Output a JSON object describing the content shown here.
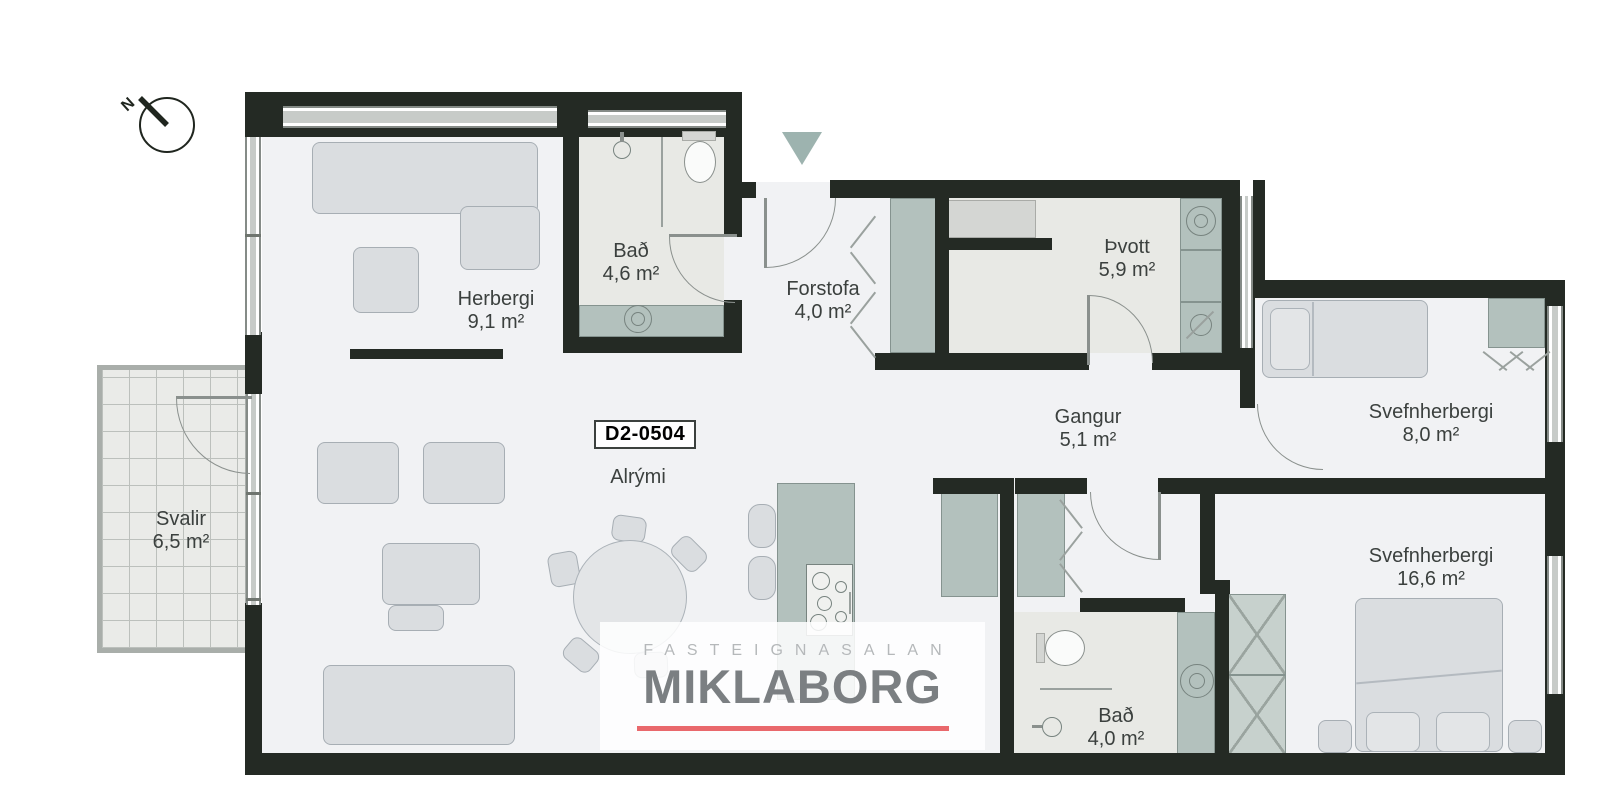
{
  "compass": {
    "label": "N"
  },
  "unit": {
    "code": "D2-0504",
    "open_area_label": "Alrými"
  },
  "rooms": [
    {
      "name": "Herbergi",
      "area": "9,1 m²"
    },
    {
      "name": "Bað",
      "area": "4,6 m²"
    },
    {
      "name": "Forstofa",
      "area": "4,0 m²"
    },
    {
      "name": "Þvott",
      "area": "5,9 m²"
    },
    {
      "name": "Gangur",
      "area": "5,1 m²"
    },
    {
      "name": "Svefnherbergi",
      "area": "8,0 m²"
    },
    {
      "name": "Svefnherbergi",
      "area": "16,6 m²"
    },
    {
      "name": "Bað",
      "area": "4,0 m²"
    },
    {
      "name": "Svalir",
      "area": "6,5 m²"
    }
  ],
  "logo": {
    "tagline": "FASTEIGNASALAN",
    "brand": "MIKLABORG"
  },
  "colors": {
    "wall": "#242a24",
    "floor_light": "#f1f2f4",
    "floor_gray": "#e8e9e5",
    "fixture_teal": "#b3c1bd",
    "furniture_gray": "#dadde0",
    "window_gray": "#c7cbc8",
    "entrance_arrow": "#9db3af",
    "accent_red": "#e9686c",
    "logo_gray": "#7b7f82",
    "logo_light_gray": "#b5b8ba",
    "text": "#3b403e"
  }
}
